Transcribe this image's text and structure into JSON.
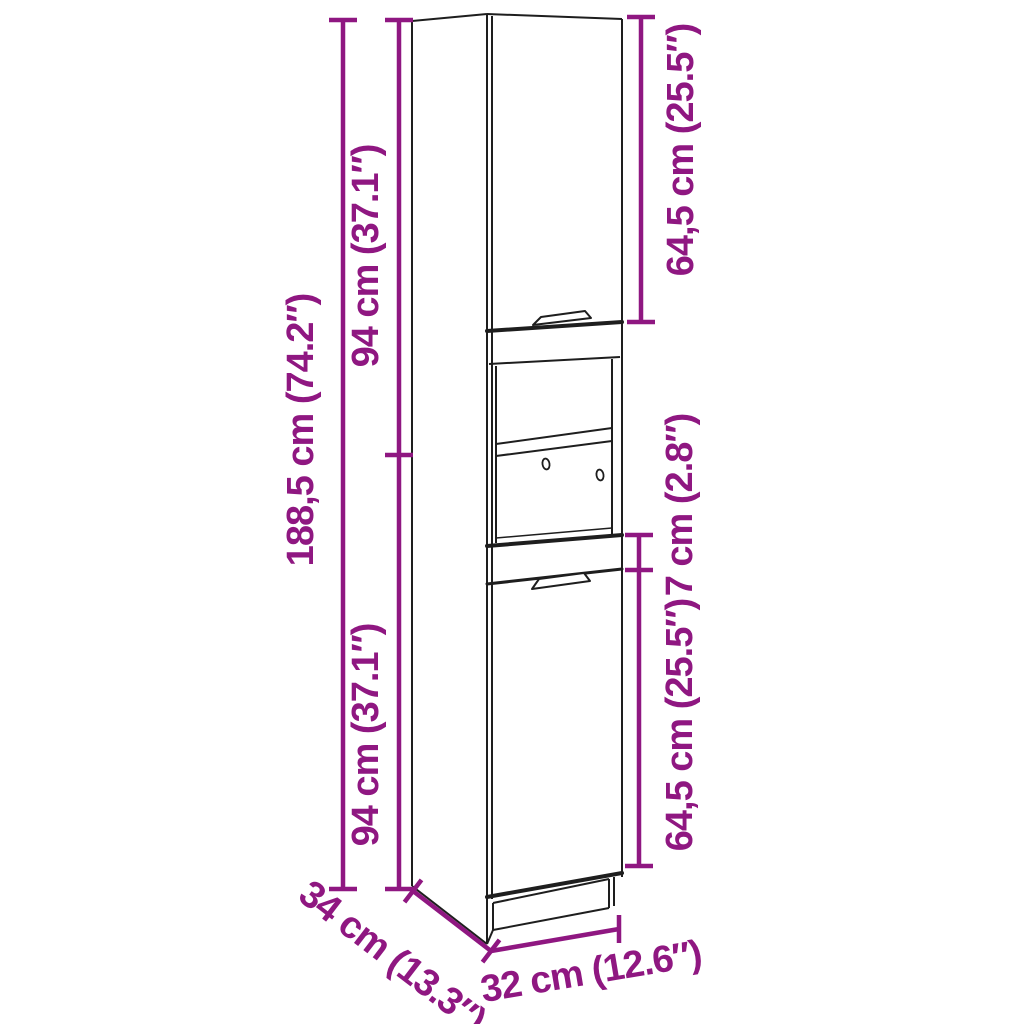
{
  "diagram": {
    "description": "Line drawing of a tall narrow cabinet with two doors and an open middle shelf compartment, annotated with dimension lines",
    "colors": {
      "dimension_accent": "#8F1781",
      "line": "#1E1E1E",
      "background": "#FFFFFF"
    },
    "labels": {
      "total_height": "188,5 cm (74.2″)",
      "upper_section_height": "94 cm (37.1″)",
      "lower_section_height": "94 cm (37.1″)",
      "upper_door_height": "64,5 cm (25.5″)",
      "middle_gap_height": "7 cm (2.8″)",
      "lower_door_height": "64,5 cm (25.5″)",
      "depth": "34 cm (13.3″)",
      "width": "32 cm (12.6″)"
    }
  }
}
